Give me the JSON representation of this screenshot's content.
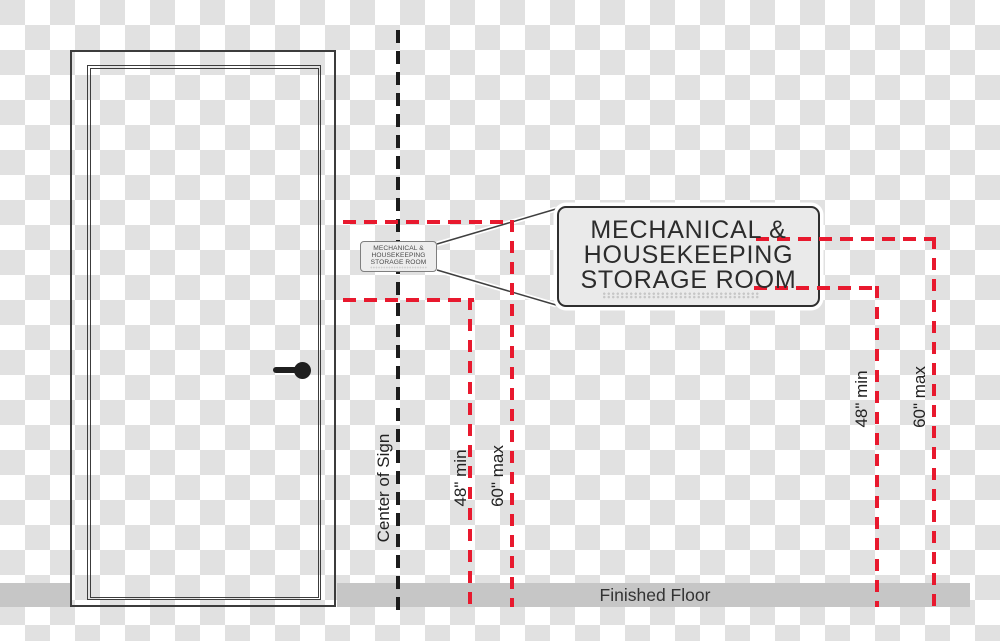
{
  "sign": {
    "lines": [
      "MECHANICAL &",
      "HOUSEKEEPING",
      "STORAGE ROOM"
    ]
  },
  "labels": {
    "center_of_sign": "Center of Sign",
    "min_height": "48\" min",
    "max_height": "60\" max",
    "finished_floor": "Finished Floor"
  },
  "colors": {
    "measure_red": "#e8192e",
    "floor_gray": "#c6c6c6",
    "checker_gray": "#e1e1e1",
    "line_dark": "#3c3c3c",
    "sign_fill": "#eaeaea"
  }
}
